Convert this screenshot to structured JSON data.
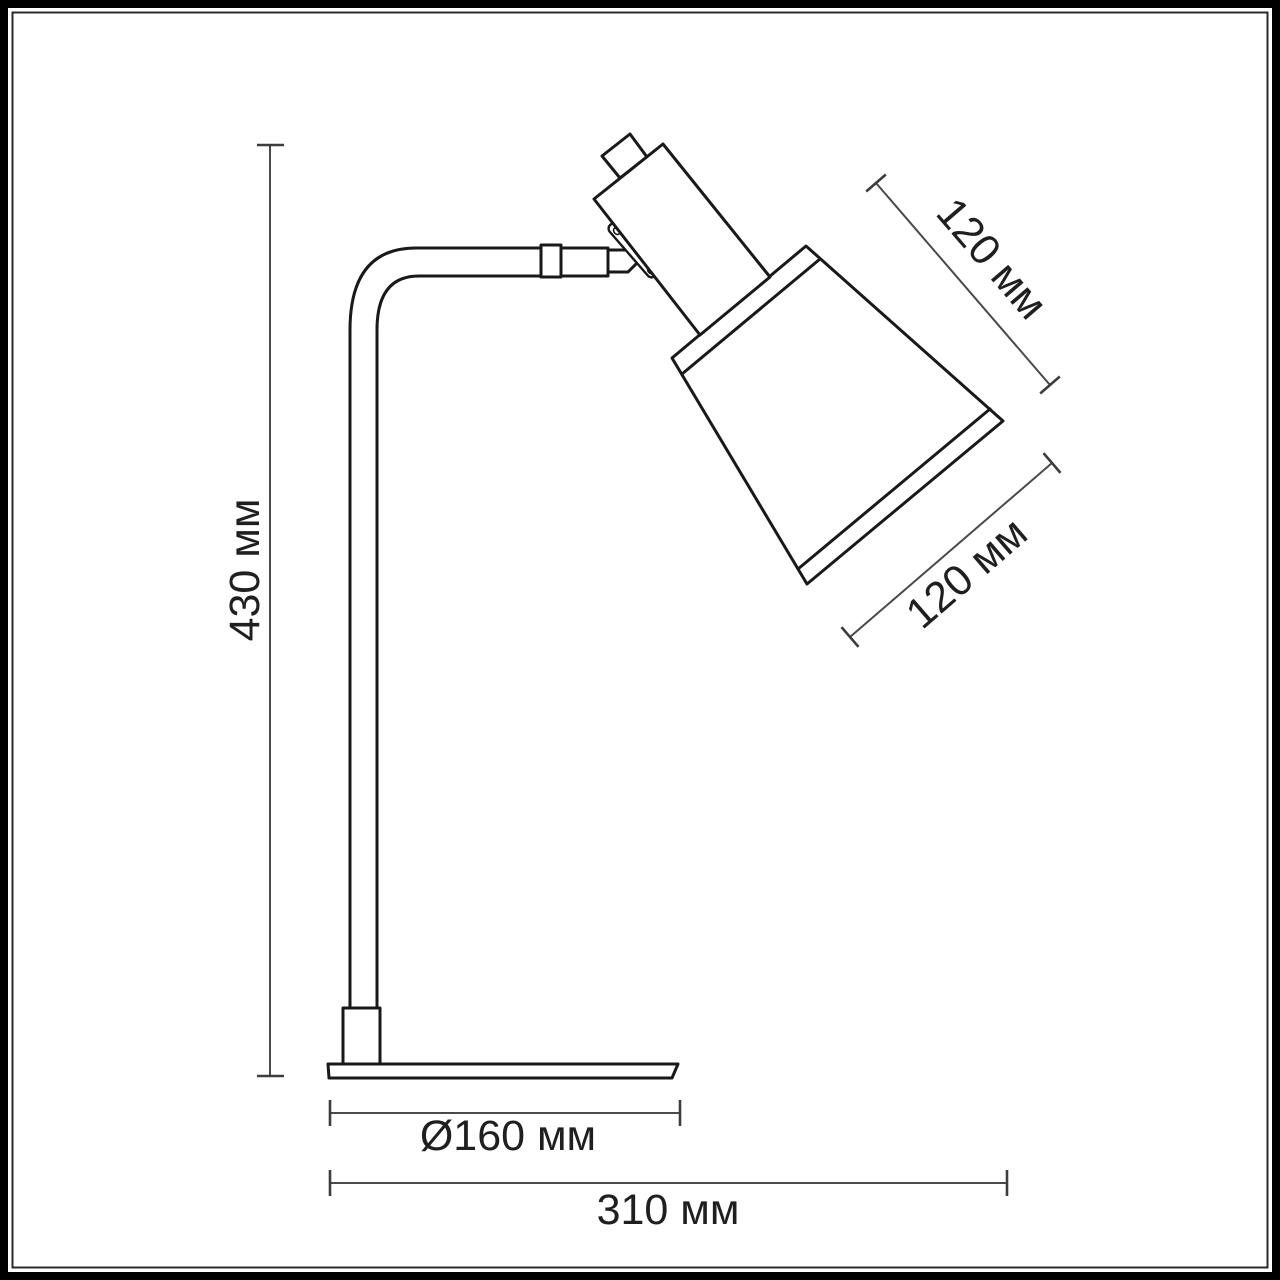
{
  "figure": {
    "subject": "desk-lamp-side-view-technical-drawing",
    "units": "мм",
    "colors": {
      "background": "#ffffff",
      "drawing_line": "#191919",
      "dimension_line": "#4a4a4a",
      "text": "#1f1f1f",
      "frame": "#000000"
    }
  },
  "dimensions": {
    "height": {
      "label": "430 мм",
      "value_mm": 430
    },
    "shade_height": {
      "label": "120 мм",
      "value_mm": 120
    },
    "shade_opening": {
      "label": "120 мм",
      "value_mm": 120
    },
    "base_diameter": {
      "label": "Ø160 мм",
      "value_mm": 160
    },
    "overall_depth": {
      "label": "310 мм",
      "value_mm": 310
    }
  }
}
